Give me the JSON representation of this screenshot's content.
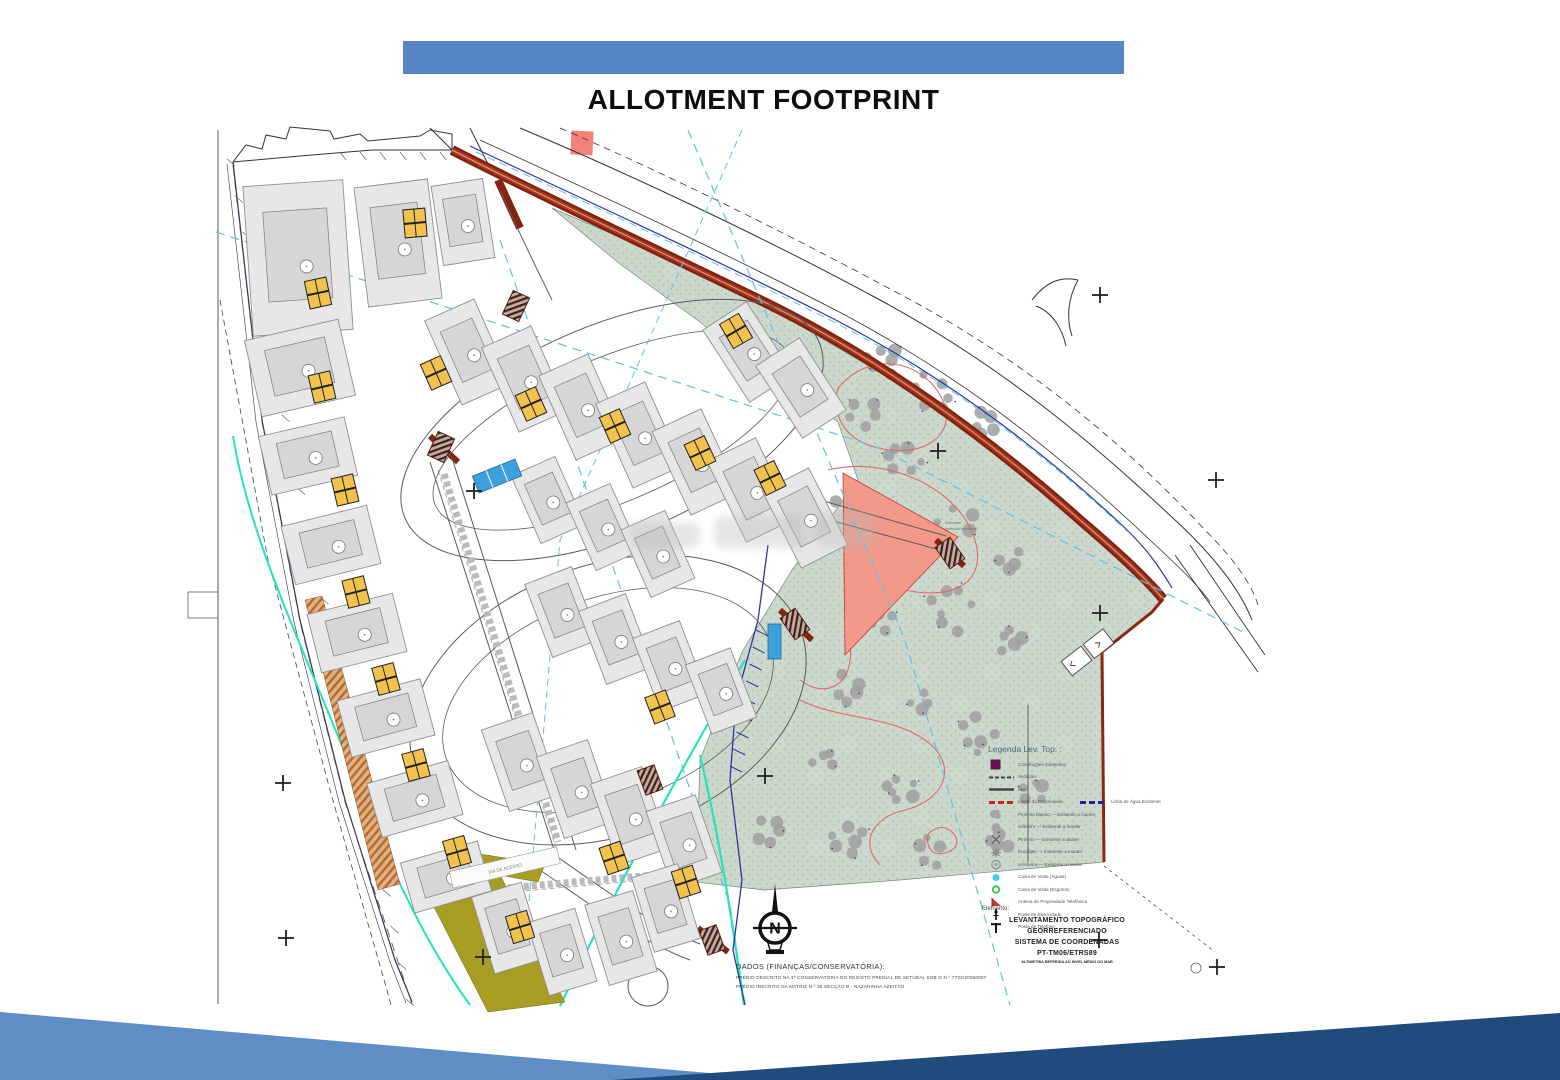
{
  "slide": {
    "title": "ALLOTMENT FOOTPRINT"
  },
  "plan": {
    "street_label": "VIA DE ACESSO",
    "park_note_line1": "Sobrante",
    "park_note_line2": "Em Recuperação Ambiental",
    "north_letter": "N",
    "legend": {
      "title": "Legenda Lev. Top. :",
      "items": [
        {
          "symbol": "square-purple-icon",
          "label": "Construções Existentes"
        },
        {
          "symbol": "line-dashed-icon",
          "label": "Vedação"
        },
        {
          "symbol": "line-solid-icon",
          "label": "Muro"
        },
        {
          "symbol": "line-red-dashed-icon",
          "label": "Limite da Propriedade"
        },
        {
          "symbol": "line-blue-dashed-icon",
          "label": "Linha de Água Existente",
          "inline_with_prev": true
        },
        {
          "symbol": "tree-cluster-icon",
          "label": "Pinheiro Manso — Existente a manter"
        },
        {
          "symbol": "tree-round-icon",
          "label": "Sobreiro — Existente a manter"
        },
        {
          "symbol": "tree-x-icon",
          "label": "Pinheiro — Existente a abater"
        },
        {
          "symbol": "tree-gear-icon",
          "label": "Eucalipto — Existente a manter"
        },
        {
          "symbol": "tree-ring-icon",
          "label": "Azinheira — Existente a manter"
        },
        {
          "symbol": "dot-cyan-icon",
          "label": "Caixa de Visita (Águas)"
        },
        {
          "symbol": "ring-green-icon",
          "label": "Caixa de Visita (Esgotos)"
        },
        {
          "symbol": "flag-red-icon",
          "label": "Antena de Propriedade Telefónica"
        },
        {
          "symbol": "pole-icon",
          "label": "Poste de Eletricidade"
        },
        {
          "symbol": "tee-icon",
          "label": "Poste de Telefone"
        }
      ]
    },
    "element_block": {
      "heading": "Elemento:",
      "lines": [
        "LEVANTAMENTO TOPOGRÁFICO",
        "GEORREFERENCIADO",
        "SISTEMA DE COORDENADAS",
        "PT-TM06/ETRS89"
      ],
      "subline": "ALTIMETRIA REFERIDA AO NÍVEL MÉDIO DO MAR"
    },
    "dados_block": {
      "heading": "DADOS (FINANÇAS/CONSERVATÓRIA):",
      "lines": [
        "PRÉDIO DESCRITO NA 2ª CONSERVATÓRIA DO REGISTO PREDIAL DE SETÚBAL SOB O N.º 7702/20050907",
        "PRÉDIO INSCRITO NA MATRIZ N.º 35 SECÇÃO B - NAZARINHA AZEITÃO"
      ]
    }
  },
  "colors": {
    "header_bar": "#5586c3",
    "footer_light": "#5f8dc6",
    "footer_dark": "#1f4b7d",
    "road_maroon": "#8a2811",
    "park_green": "#cdd8cd",
    "plot_gray": "#e7e7e7",
    "plot_inner_gray": "#d6d6d6",
    "garage_yellow": "#f1c34e",
    "reserve_pink": "#f2998a",
    "strip_olive": "#a79d22",
    "strip_tan": "#c07b3e",
    "utility_teal": "#27e2be",
    "utility_cyan": "#5ec1e6",
    "utility_navy": "#2b35a0",
    "contour_red": "#e06a63",
    "legend_purple": "#6d0a5a",
    "parking_blue": "#3da0dc"
  }
}
